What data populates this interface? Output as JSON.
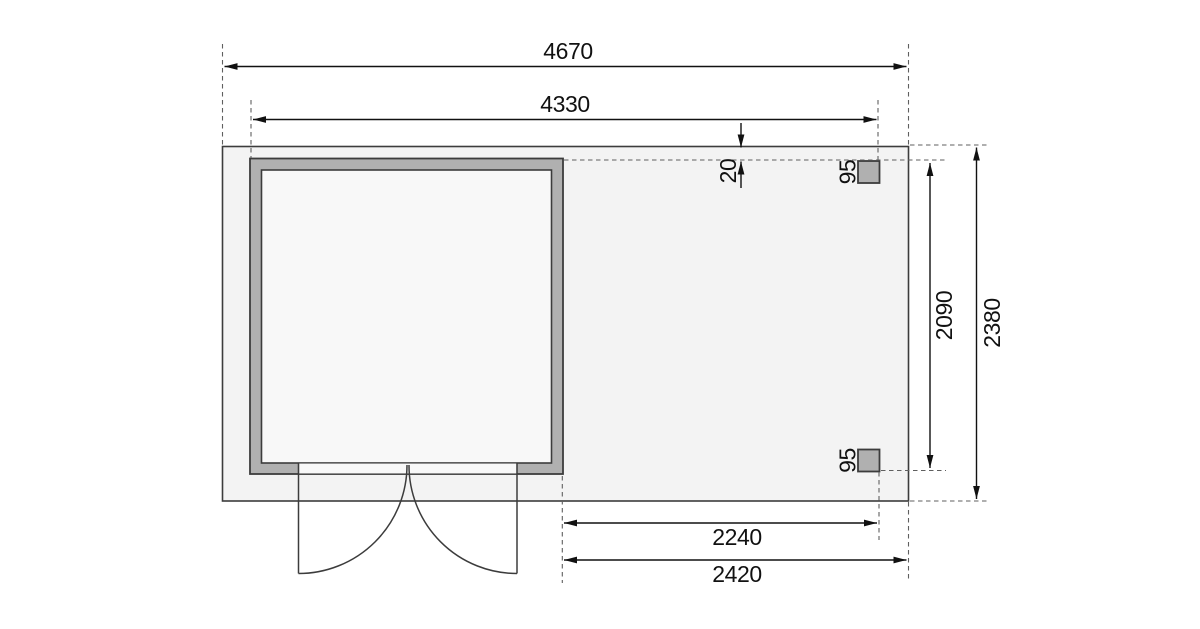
{
  "drawing": {
    "type": "floor-plan",
    "dimensions": {
      "overall_width": "4670",
      "shed_width": "4330",
      "roof_offset": "20",
      "post_top": "95",
      "post_bottom": "95",
      "inner_depth": "2090",
      "overall_depth": "2380",
      "annex_inner_width": "2240",
      "annex_width": "2420"
    },
    "colors": {
      "background": "#ffffff",
      "platform_fill": "#f3f3f3",
      "wall_fill": "#b0b0b0",
      "interior_fill": "#f8f8f8",
      "line": "#3c3c3c",
      "dimension": "#111111"
    }
  }
}
